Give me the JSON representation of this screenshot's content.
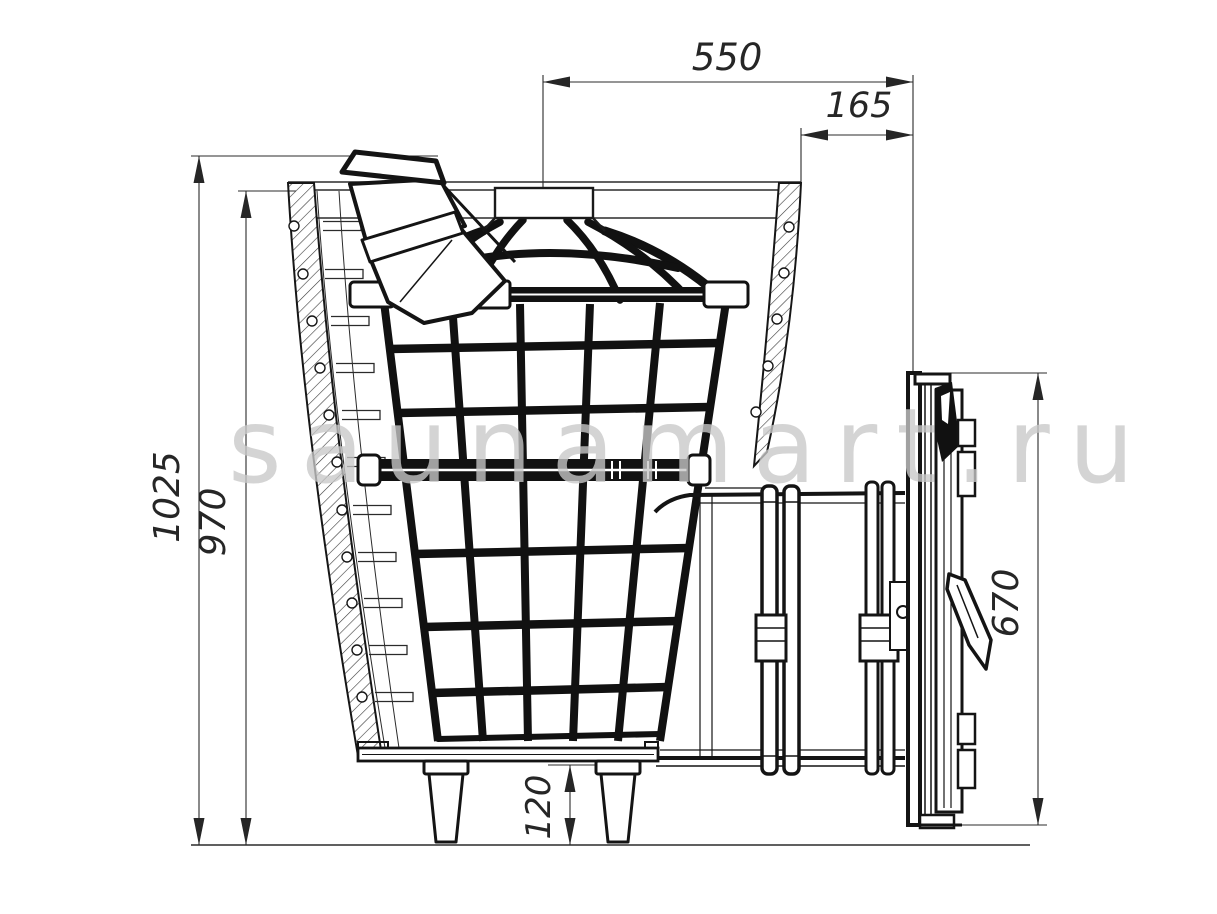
{
  "drawing": {
    "kind": "technical-drawing",
    "subject": "sauna stove side section view with stone cage, loading tunnel and door panel",
    "units": "mm",
    "background": "#ffffff",
    "line_color": "#141414",
    "dim_color": "#2b2b2b"
  },
  "watermark": {
    "text": "saunamart.ru",
    "color": "#c9c9c9"
  },
  "dimensions": {
    "top_width": {
      "label": "550",
      "orientation": "horizontal"
    },
    "door_offset": {
      "label": "165",
      "orientation": "horizontal"
    },
    "overall_height": {
      "label": "1025",
      "orientation": "vertical"
    },
    "body_height": {
      "label": "970",
      "orientation": "vertical"
    },
    "door_panel_height": {
      "label": "670",
      "orientation": "vertical"
    },
    "leg_height": {
      "label": "120",
      "orientation": "vertical"
    }
  }
}
